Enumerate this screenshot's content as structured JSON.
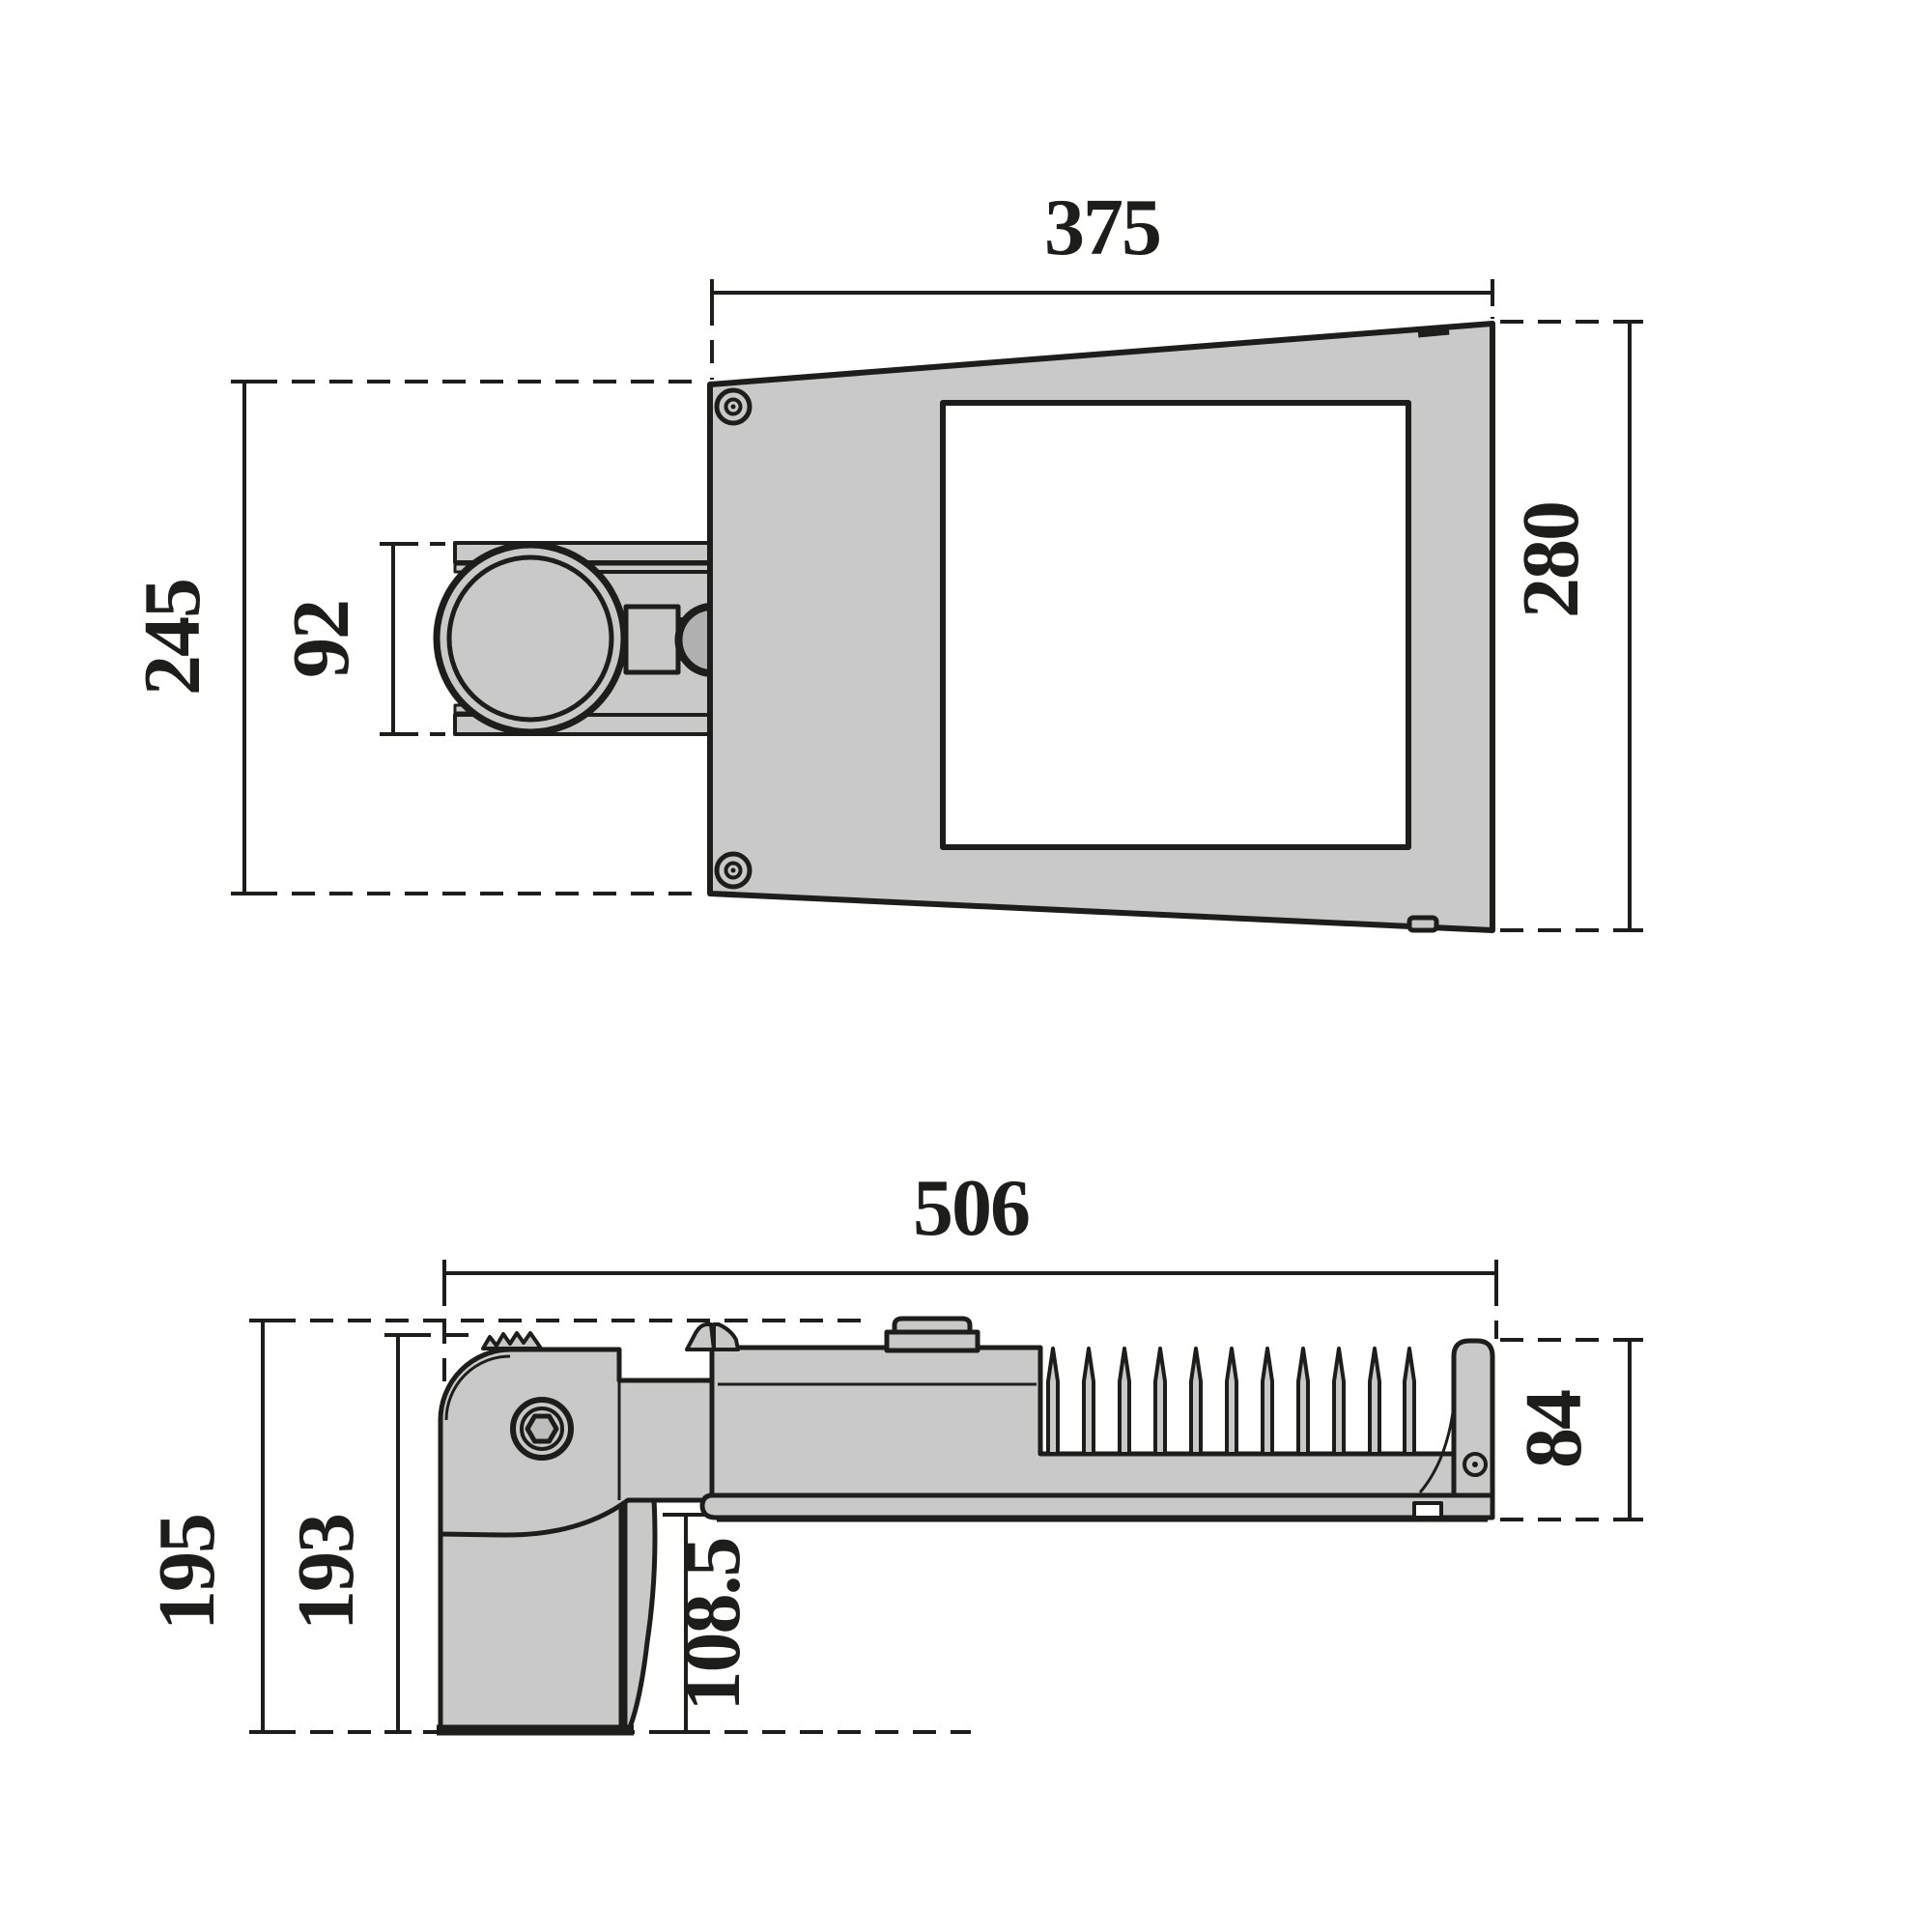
{
  "drawing": {
    "type": "technical-dimension-drawing",
    "subject": "street-light-luminaire-two-views",
    "colors": {
      "body_fill": "#c9c9c9",
      "outline": "#1d1d1b",
      "dimension_line": "#1d1d1b",
      "window_fill": "#ffffff",
      "background": "#ffffff"
    },
    "views": {
      "top": {
        "dimensions": {
          "width": "375",
          "height_right": "280",
          "height_left": "245",
          "bracket_height": "92"
        }
      },
      "side": {
        "dimensions": {
          "length": "506",
          "housing_height": "84",
          "total_height": "195",
          "bracket_height": "193",
          "underhang": "108.5"
        }
      }
    }
  }
}
